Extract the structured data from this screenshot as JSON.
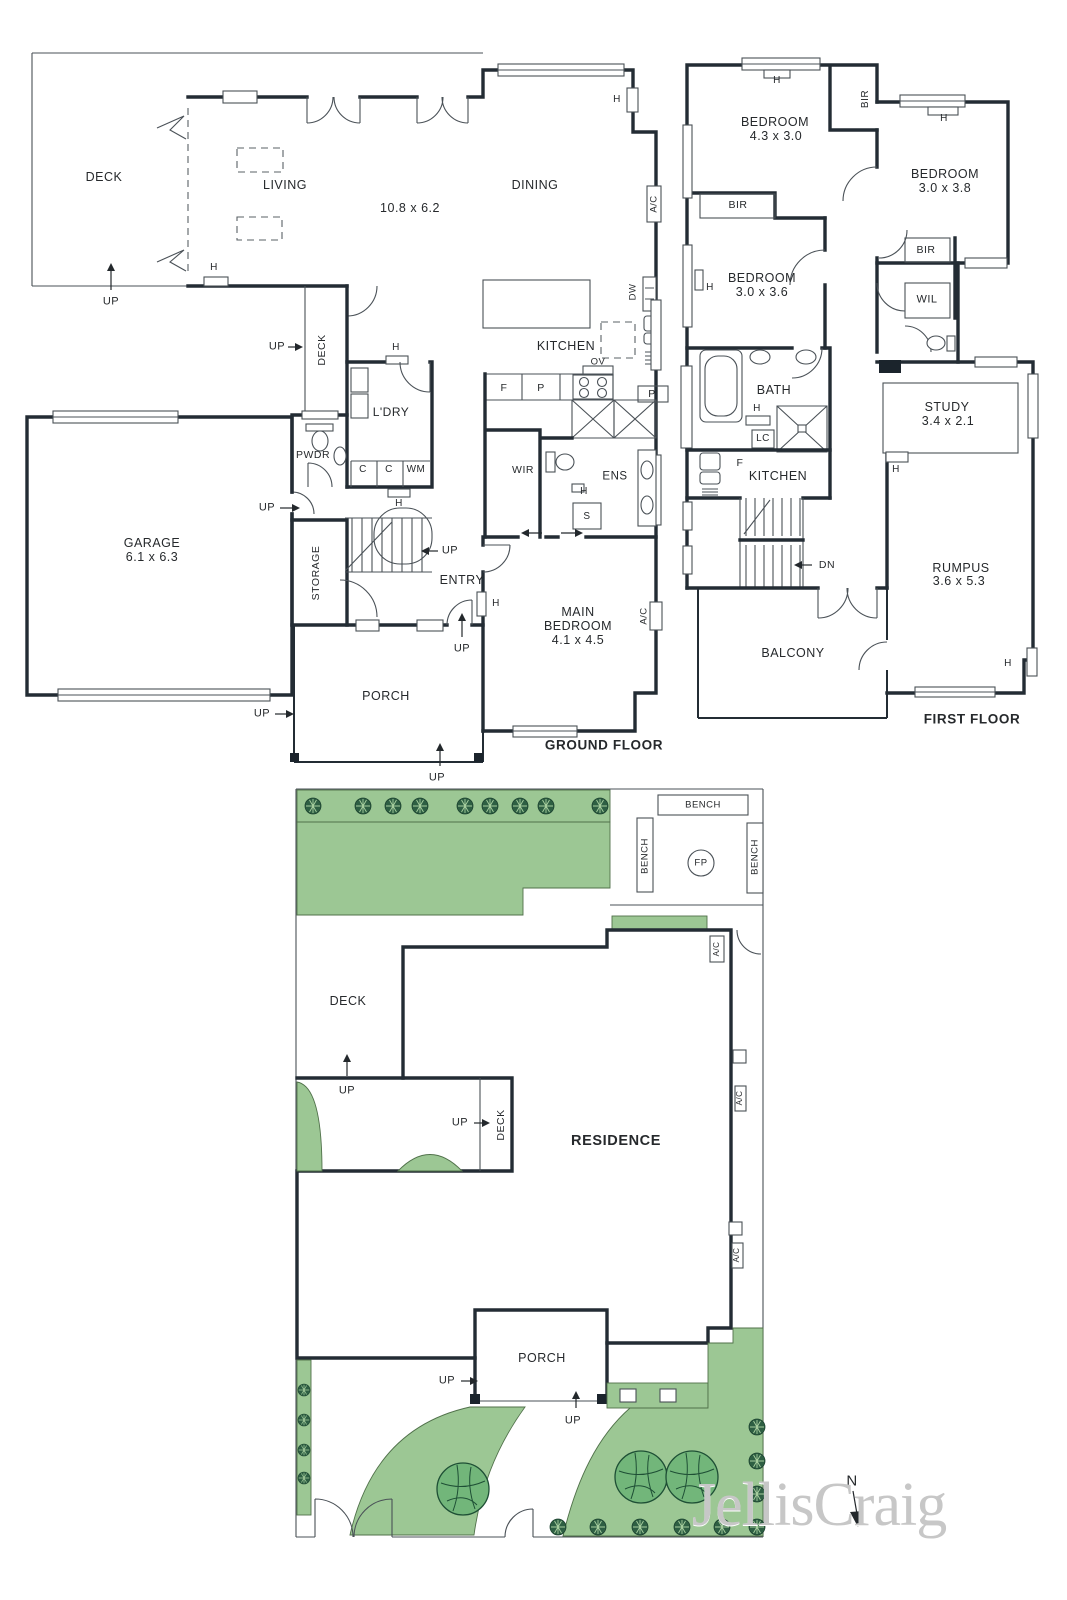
{
  "meta": {
    "watermark": "JellisCraig"
  },
  "labels": [
    {
      "name": "deck-label",
      "text": "DECK",
      "x": 104,
      "y": 177,
      "size": 12.5
    },
    {
      "name": "living-label",
      "text": "LIVING",
      "x": 285,
      "y": 185,
      "size": 12.5
    },
    {
      "name": "living-dims",
      "text": "10.8 x 6.2",
      "x": 410,
      "y": 208,
      "size": 12.5
    },
    {
      "name": "dining-label",
      "text": "DINING",
      "x": 535,
      "y": 185,
      "size": 12.5
    },
    {
      "name": "kitchen-label",
      "text": "KITCHEN",
      "x": 566,
      "y": 346,
      "size": 12.5
    },
    {
      "name": "laundry-label",
      "text": "L'DRY",
      "x": 391,
      "y": 412,
      "size": 12
    },
    {
      "name": "powder-label",
      "text": "PWDR",
      "x": 313,
      "y": 455,
      "size": 10.5
    },
    {
      "name": "garage-label",
      "text": "GARAGE",
      "x": 152,
      "y": 543,
      "size": 12.5
    },
    {
      "name": "garage-dims",
      "text": "6.1 x 6.3",
      "x": 152,
      "y": 557,
      "size": 12.5
    },
    {
      "name": "storage-label",
      "text": "STORAGE",
      "x": 316,
      "y": 573,
      "size": 10.5,
      "rot": -90
    },
    {
      "name": "entry-label",
      "text": "ENTRY",
      "x": 462,
      "y": 580,
      "size": 12.5
    },
    {
      "name": "main-bedroom-line1",
      "text": "MAIN",
      "x": 578,
      "y": 612,
      "size": 12.5
    },
    {
      "name": "main-bedroom-line2",
      "text": "BEDROOM",
      "x": 578,
      "y": 626,
      "size": 12.5
    },
    {
      "name": "main-bedroom-dims",
      "text": "4.1 x 4.5",
      "x": 578,
      "y": 640,
      "size": 12.5
    },
    {
      "name": "porch-label",
      "text": "PORCH",
      "x": 386,
      "y": 696,
      "size": 12.5
    },
    {
      "name": "wir-label",
      "text": "WIR",
      "x": 523,
      "y": 470,
      "size": 10.5
    },
    {
      "name": "ens-label",
      "text": "ENS",
      "x": 615,
      "y": 477,
      "size": 11.5
    },
    {
      "name": "side-deck-label",
      "text": "DECK",
      "x": 322,
      "y": 350,
      "size": 10.5,
      "rot": -90
    },
    {
      "name": "up-arrow-label",
      "text": "UP",
      "x": 111,
      "y": 302,
      "size": 11
    },
    {
      "name": "up-arrow-label",
      "text": "UP",
      "x": 277,
      "y": 347,
      "size": 11
    },
    {
      "name": "up-arrow-label",
      "text": "UP",
      "x": 267,
      "y": 508,
      "size": 11
    },
    {
      "name": "up-arrow-label",
      "text": "UP",
      "x": 450,
      "y": 551,
      "size": 11
    },
    {
      "name": "up-arrow-label",
      "text": "UP",
      "x": 462,
      "y": 649,
      "size": 11
    },
    {
      "name": "up-arrow-label",
      "text": "UP",
      "x": 262,
      "y": 714,
      "size": 11
    },
    {
      "name": "up-arrow-label",
      "text": "UP",
      "x": 437,
      "y": 778,
      "size": 11
    },
    {
      "name": "heater-label",
      "text": "H",
      "x": 214,
      "y": 268,
      "size": 10
    },
    {
      "name": "heater-label",
      "text": "H",
      "x": 617,
      "y": 100,
      "size": 10
    },
    {
      "name": "heater-label",
      "text": "H",
      "x": 396,
      "y": 348,
      "size": 10
    },
    {
      "name": "heater-label",
      "text": "H",
      "x": 399,
      "y": 504,
      "size": 10
    },
    {
      "name": "heater-label",
      "text": "H",
      "x": 496,
      "y": 604,
      "size": 10
    },
    {
      "name": "heater-label",
      "text": "H",
      "x": 584,
      "y": 492,
      "size": 10
    },
    {
      "name": "ac-label",
      "text": "A/C",
      "x": 654,
      "y": 204,
      "size": 9.5,
      "rot": -90
    },
    {
      "name": "ac-label",
      "text": "A/C",
      "x": 644,
      "y": 616,
      "size": 9.5,
      "rot": -90
    },
    {
      "name": "dishwasher-label",
      "text": "DW",
      "x": 633,
      "y": 292,
      "size": 9.5,
      "rot": -90
    },
    {
      "name": "oven-label",
      "text": "OV",
      "x": 598,
      "y": 362,
      "size": 9.5
    },
    {
      "name": "fridge-label",
      "text": "F",
      "x": 504,
      "y": 388,
      "size": 10.5
    },
    {
      "name": "pantry-label",
      "text": "P",
      "x": 541,
      "y": 388,
      "size": 10.5
    },
    {
      "name": "pantry-label",
      "text": "P",
      "x": 652,
      "y": 394,
      "size": 10.5
    },
    {
      "name": "cupboard-label",
      "text": "C",
      "x": 363,
      "y": 470,
      "size": 10
    },
    {
      "name": "cupboard-label",
      "text": "C",
      "x": 389,
      "y": 470,
      "size": 10
    },
    {
      "name": "washing-machine-label",
      "text": "WM",
      "x": 416,
      "y": 470,
      "size": 10
    },
    {
      "name": "shower-label",
      "text": "S",
      "x": 587,
      "y": 517,
      "size": 10
    },
    {
      "name": "ground-floor-title",
      "text": "GROUND FLOOR",
      "x": 604,
      "y": 745,
      "size": 13.5,
      "bold": true
    },
    {
      "name": "bedroom-label",
      "text": "BEDROOM",
      "x": 775,
      "y": 122,
      "size": 12.5
    },
    {
      "name": "bedroom-dims",
      "text": "4.3 x 3.0",
      "x": 776,
      "y": 136,
      "size": 12.5
    },
    {
      "name": "bedroom-label",
      "text": "BEDROOM",
      "x": 945,
      "y": 174,
      "size": 12.5
    },
    {
      "name": "bedroom-dims",
      "text": "3.0 x 3.8",
      "x": 945,
      "y": 188,
      "size": 12.5
    },
    {
      "name": "bedroom-label",
      "text": "BEDROOM",
      "x": 762,
      "y": 278,
      "size": 12.5
    },
    {
      "name": "bedroom-dims",
      "text": "3.0 x 3.6",
      "x": 762,
      "y": 292,
      "size": 12.5
    },
    {
      "name": "bir-label",
      "text": "BIR",
      "x": 866,
      "y": 99,
      "size": 10,
      "rot": -90
    },
    {
      "name": "bir-label",
      "text": "BIR",
      "x": 738,
      "y": 205,
      "size": 10.5
    },
    {
      "name": "bir-label",
      "text": "BIR",
      "x": 926,
      "y": 250,
      "size": 10.5
    },
    {
      "name": "wil-label",
      "text": "WIL",
      "x": 927,
      "y": 300,
      "size": 11
    },
    {
      "name": "bath-label",
      "text": "BATH",
      "x": 774,
      "y": 390,
      "size": 12.5
    },
    {
      "name": "linen-label",
      "text": "LC",
      "x": 763,
      "y": 439,
      "size": 10
    },
    {
      "name": "ff-kitchen-label",
      "text": "KITCHEN",
      "x": 778,
      "y": 476,
      "size": 12.5
    },
    {
      "name": "fridge-label",
      "text": "F",
      "x": 740,
      "y": 463,
      "size": 10.5
    },
    {
      "name": "study-label",
      "text": "STUDY",
      "x": 947,
      "y": 407,
      "size": 12.5
    },
    {
      "name": "study-dims",
      "text": "3.4 x 2.1",
      "x": 948,
      "y": 421,
      "size": 12.5
    },
    {
      "name": "rumpus-label",
      "text": "RUMPUS",
      "x": 961,
      "y": 568,
      "size": 12.5
    },
    {
      "name": "rumpus-dims",
      "text": "3.6 x 5.3",
      "x": 959,
      "y": 581,
      "size": 12.5
    },
    {
      "name": "balcony-label",
      "text": "BALCONY",
      "x": 793,
      "y": 653,
      "size": 12.5
    },
    {
      "name": "down-arrow-label",
      "text": "DN",
      "x": 827,
      "y": 565,
      "size": 10.5
    },
    {
      "name": "heater-label",
      "text": "H",
      "x": 777,
      "y": 81,
      "size": 10
    },
    {
      "name": "heater-label",
      "text": "H",
      "x": 944,
      "y": 119,
      "size": 10
    },
    {
      "name": "heater-label",
      "text": "H",
      "x": 710,
      "y": 288,
      "size": 10
    },
    {
      "name": "heater-label",
      "text": "H",
      "x": 757,
      "y": 409,
      "size": 10
    },
    {
      "name": "heater-label",
      "text": "H",
      "x": 896,
      "y": 470,
      "size": 10
    },
    {
      "name": "heater-label",
      "text": "H",
      "x": 1008,
      "y": 664,
      "size": 10
    },
    {
      "name": "first-floor-title",
      "text": "FIRST FLOOR",
      "x": 972,
      "y": 719,
      "size": 13.5,
      "bold": true
    },
    {
      "name": "bench-label",
      "text": "BENCH",
      "x": 703,
      "y": 805,
      "size": 9.5
    },
    {
      "name": "bench-label",
      "text": "BENCH",
      "x": 645,
      "y": 856,
      "size": 9.5,
      "rot": -90
    },
    {
      "name": "bench-label",
      "text": "BENCH",
      "x": 755,
      "y": 857,
      "size": 9.5,
      "rot": -90
    },
    {
      "name": "firepit-label",
      "text": "FP",
      "x": 701,
      "y": 863,
      "size": 9.5
    },
    {
      "name": "site-deck-label",
      "text": "DECK",
      "x": 348,
      "y": 1001,
      "size": 12.5
    },
    {
      "name": "site-deck-label",
      "text": "DECK",
      "x": 501,
      "y": 1125,
      "size": 10.5,
      "rot": -90
    },
    {
      "name": "residence-label",
      "text": "RESIDENCE",
      "x": 616,
      "y": 1141,
      "size": 14.5,
      "bold": true
    },
    {
      "name": "site-porch-label",
      "text": "PORCH",
      "x": 542,
      "y": 1358,
      "size": 12.5
    },
    {
      "name": "up-arrow-label",
      "text": "UP",
      "x": 347,
      "y": 1091,
      "size": 11
    },
    {
      "name": "up-arrow-label",
      "text": "UP",
      "x": 460,
      "y": 1123,
      "size": 11
    },
    {
      "name": "up-arrow-label",
      "text": "UP",
      "x": 447,
      "y": 1381,
      "size": 11
    },
    {
      "name": "up-arrow-label",
      "text": "UP",
      "x": 573,
      "y": 1421,
      "size": 11
    },
    {
      "name": "ac-label",
      "text": "A/C",
      "x": 717,
      "y": 949,
      "size": 8,
      "rot": -90
    },
    {
      "name": "ac-label",
      "text": "A/C",
      "x": 740,
      "y": 1098,
      "size": 8,
      "rot": -90
    },
    {
      "name": "ac-label",
      "text": "A/C",
      "x": 737,
      "y": 1255,
      "size": 8,
      "rot": -90
    },
    {
      "name": "compass-label",
      "text": "N",
      "x": 852,
      "y": 1481,
      "size": 15
    }
  ]
}
